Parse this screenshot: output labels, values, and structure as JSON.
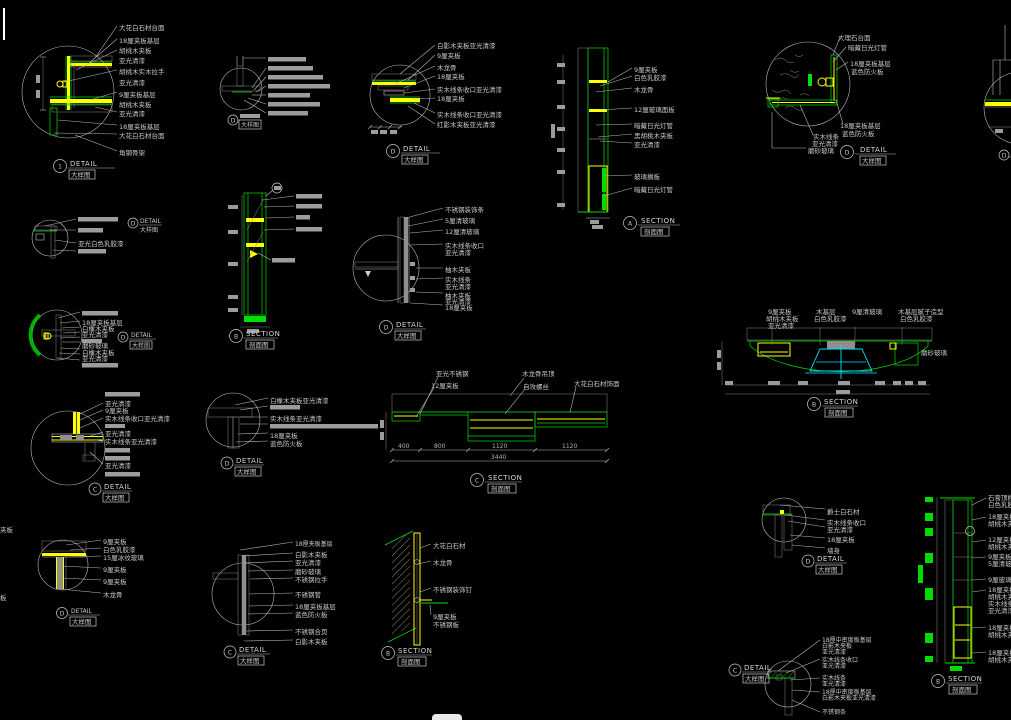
{
  "sheet": {
    "background": "#000000",
    "colors": {
      "line_green": "#00dc00",
      "accent_yellow": "#ffff00",
      "light_cyan": "#00e5ff",
      "text_gray": "#c9c9c9"
    }
  },
  "details": {
    "d1": {
      "id": "1",
      "t": "DETAIL",
      "s": "大样图",
      "L": [
        "大花白石材台面",
        "18厘夹板基层",
        "胡桃木夹板",
        "亚光清漆",
        "胡桃木实木拉手",
        "亚光清漆",
        "9厘夹板基层",
        "胡桃木夹板",
        "亚光清漆",
        "18厘夹板基层",
        "大花白石材台面",
        "角钢骨架"
      ]
    },
    "d2": {
      "id": "D",
      "s": "大样图"
    },
    "d3": {
      "id": "D",
      "t": "DETAIL",
      "s": "大样图",
      "L": [
        "白影木夹板亚光清漆",
        "9厘夹板",
        "木龙骨",
        "18厘夹板",
        "实木线条收口亚光清漆",
        "18厘夹板",
        "实木线条收口亚光清漆",
        "红影木夹板亚光清漆"
      ]
    },
    "s1": {
      "id": "A",
      "t": "SECTION",
      "s": "剖面图",
      "L": [
        "9厘夹板",
        "白色乳胶漆",
        "木龙骨",
        "12厘玻璃面板",
        "暗藏日光灯管",
        "黑胡桃木夹板",
        "亚光清漆",
        "玻璃搁板",
        "暗藏日光灯管"
      ]
    },
    "d4": {
      "id": "D",
      "t": "DETAIL",
      "s": "大样图",
      "L": [
        "大理石台面",
        "暗藏日光灯管",
        "18厘夹板基层",
        "蓝色防火板",
        "18厘夹板基层",
        "蓝色防火板",
        "实木线条",
        "亚光清漆",
        "磨砂玻璃"
      ]
    },
    "d14": {
      "id": "D"
    },
    "d5": {
      "id": "D",
      "t": "DETAIL",
      "s": "大样图",
      "L": [
        "亚光白色乳胶漆"
      ]
    },
    "s2": {
      "id": "B",
      "t": "SECTION",
      "s": "剖面图"
    },
    "d6": {
      "id": "D",
      "t": "DETAIL",
      "s": "大样图",
      "L": [
        "不锈钢装饰条",
        "5厘清玻璃",
        "12厘清玻璃",
        "实木线条收口",
        "亚光清漆",
        "柚木夹板",
        "实木线条",
        "亚光清漆",
        "柚木夹板",
        "亚光清漆",
        "18厘夹板"
      ]
    },
    "d7": {
      "id": "D",
      "t": "DETAIL",
      "s": "大样图",
      "L": [
        "18厘夹板基层",
        "白橡木夹板",
        "亚光清漆",
        "磨砂玻璃",
        "白橡木夹板",
        "亚光清漆"
      ]
    },
    "d8": {
      "id": "C",
      "t": "DETAIL",
      "s": "大样图",
      "L": [
        "亚光清漆",
        "9厘夹板",
        "实木线条收口亚光清漆",
        "亚光清漆",
        "实木线条亚光清漆",
        "亚光清漆"
      ]
    },
    "d9": {
      "id": "D",
      "t": "DETAIL",
      "s": "大样图",
      "L": [
        "白橡木夹板亚光清漆",
        "实木线条亚光清漆",
        "18厘夹板",
        "蓝色防火板"
      ]
    },
    "s3": {
      "id": "C",
      "t": "SECTION",
      "s": "剖面图",
      "L": [
        "亚光不锈钢",
        "12厘夹板",
        "木龙骨吊顶",
        "自攻螺丝",
        "大花白石材饰面"
      ],
      "dims": [
        "400",
        "800",
        "1120",
        "1120"
      ],
      "total": "3440"
    },
    "s4": {
      "id": "B",
      "t": "SECTION",
      "s": "剖面图",
      "L": [
        "9厘夹板",
        "胡桃木夹板",
        "亚光清漆",
        "木基层",
        "白色乳胶漆",
        "9厘清玻璃",
        "木基层腻子造型",
        "白色乳胶漆",
        "磨砂玻璃"
      ]
    },
    "d10": {
      "id": "D",
      "t": "DETAIL",
      "s": "大样图",
      "L": [
        "9厘夹板",
        "白色乳胶漆",
        "15厘冰纹玻璃",
        "9厘夹板",
        "9厘夹板",
        "木龙骨"
      ],
      "edge": [
        "夹板",
        "板"
      ]
    },
    "d11": {
      "id": "C",
      "t": "DETAIL",
      "s": "大样图",
      "L": [
        "18厘夹板基层",
        "白影木夹板",
        "亚光清漆",
        "磨砂玻璃",
        "不锈钢拉手",
        "不锈钢管",
        "18厘夹板基层",
        "蓝色防火板",
        "不锈钢合页",
        "白影木夹板"
      ]
    },
    "s5": {
      "id": "B",
      "t": "SECTION",
      "s": "剖面图",
      "L": [
        "大花白石材",
        "木龙骨",
        "不锈钢装饰钉",
        "9厘夹板",
        "不锈钢板"
      ]
    },
    "d12": {
      "id": "D",
      "t": "DETAIL",
      "s": "大样图",
      "L": [
        "爵士白石材",
        "实木线条收口",
        "亚光清漆",
        "18厘夹板",
        "墙身"
      ]
    },
    "s6": {
      "id": "B",
      "t": "SECTION",
      "s": "剖面图",
      "L": [
        "石膏顶棚",
        "白色乳胶",
        "18厘夹板",
        "胡桃木夹",
        "12厘夹板",
        "胡桃木夹",
        "9厘夹板",
        "5厘清玻",
        "9厘玻璃",
        "18厘夹板",
        "胡桃木夹",
        "实木线条",
        "亚光清漆",
        "18厘夹板",
        "胡桃木夹",
        "18厘夹板",
        "胡桃木夹"
      ]
    },
    "d13": {
      "id": "C",
      "t": "DETAIL",
      "s": "大样图",
      "L": [
        "18厘中密度板基层",
        "白影木夹板",
        "亚光清漆",
        "实木线条收口",
        "亚光清漆",
        "实木线条",
        "亚光清漆",
        "18厘中密度板基层",
        "白影木夹板亚光清漆",
        "不锈钢条"
      ]
    }
  }
}
